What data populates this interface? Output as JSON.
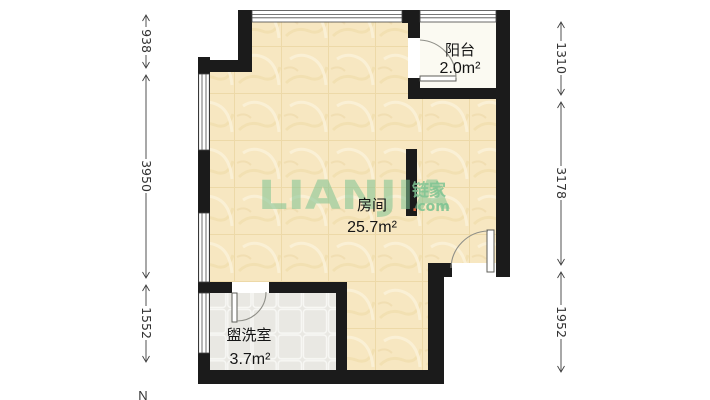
{
  "rooms": {
    "main": {
      "name": "房间",
      "area": "25.7m²"
    },
    "balcony": {
      "name": "阳台",
      "area": "2.0m²"
    },
    "washroom": {
      "name": "盥洗室",
      "area": "3.7m²"
    }
  },
  "dimensions": {
    "left": [
      "938",
      "3950",
      "1552"
    ],
    "right": [
      "1310",
      "3178",
      "1952"
    ]
  },
  "compass": {
    "north": "N"
  },
  "watermark": {
    "brand": "LIANJIA",
    "cn": "链家",
    "dot": ".",
    "com": "com"
  },
  "colors": {
    "wall": "#1B1B1B",
    "room_floor": "#F7E7C1",
    "room_floor_grid": "#EDD9A8",
    "washroom_floor": "#E9E8E3",
    "balcony_floor": "#FBFAF2",
    "watermark_green": "#7FC493",
    "watermark_dot_orange": "#EC6C3F",
    "label_text": "#151515",
    "dimension_text": "#333333"
  }
}
